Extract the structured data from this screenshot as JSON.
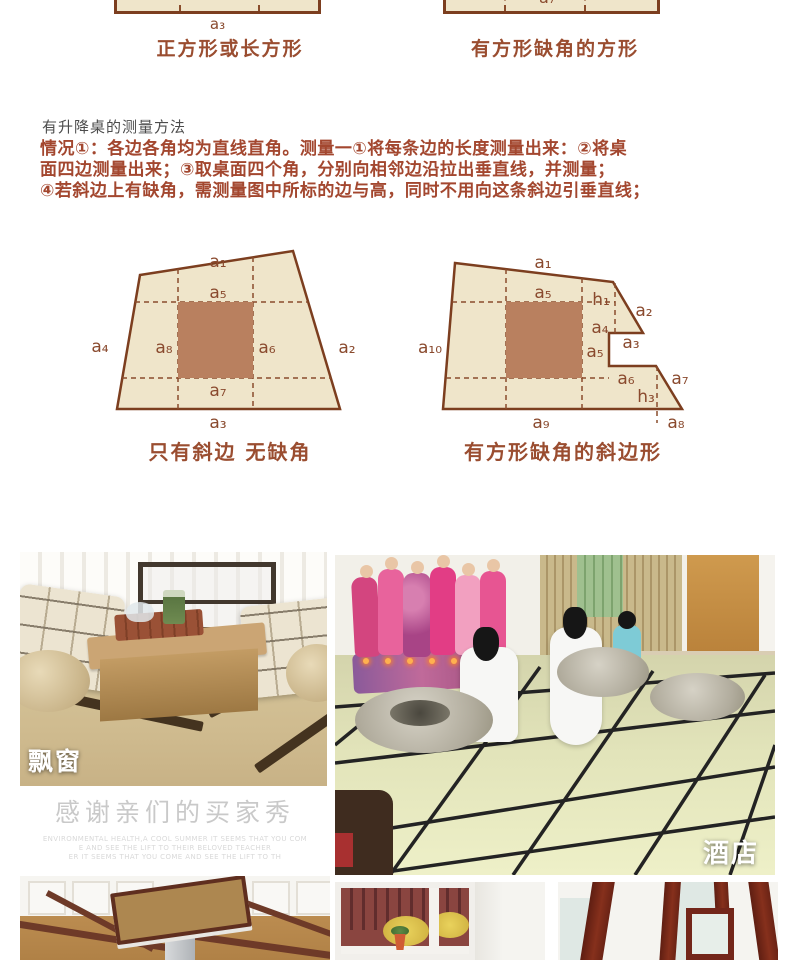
{
  "top_diagrams": {
    "left": {
      "partial_label": "a₇",
      "bottom_label": "a₃",
      "caption": "正方形或长方形"
    },
    "right": {
      "partial_label": "a₇",
      "caption": "有方形缺角的方形"
    }
  },
  "method": {
    "heading": "有升降桌的测量方法",
    "lines": [
      "情况①：各边各角均为直线直角。测量一①将每条边的长度测量出来：②将桌",
      "面四边测量出来；③取桌面四个角，分别向相邻边沿拉出垂直线，并测量；",
      "④若斜边上有缺角，需测量图中所标的边与高，同时不用向这条斜边引垂直线；"
    ]
  },
  "diagrams": {
    "left": {
      "caption": "只有斜边 无缺角",
      "labels": [
        "a₁",
        "a₂",
        "a₃",
        "a₄",
        "a₅",
        "a₆",
        "a₇",
        "a₈"
      ]
    },
    "right": {
      "caption": "有方形缺角的斜边形",
      "labels": [
        "a₁",
        "a₅",
        "h₁",
        "a₂",
        "a₄",
        "a₃",
        "a₅",
        "a₁₀",
        "a₆",
        "a₇",
        "h₃",
        "a₉",
        "a₈"
      ]
    }
  },
  "gallery": {
    "bay_window_label": "飘窗",
    "hotel_label": "酒店",
    "thanks_title": "感谢亲们的买家秀",
    "thanks_lines": [
      "ENVIRONMENTAL HEALTH,A COOL SUMMER IT SEEMS THAT YOU COM",
      "E AND SEE THE LIFT TO THEIR BELOVED TEACHER",
      "ER IT SEEMS THAT YOU COME AND SEE THE LIFT TO TH"
    ]
  },
  "colors": {
    "diagram_fill": "#efe5ca",
    "diagram_stroke": "#7c3e1f",
    "inner_square": "#b9805f",
    "dashed_line": "#8a4d2c",
    "label_text": "#8a4a2e",
    "caption_text": "#9a4d30",
    "paragraph_text": "#a3472f",
    "heading_text": "#4c4c4c"
  }
}
